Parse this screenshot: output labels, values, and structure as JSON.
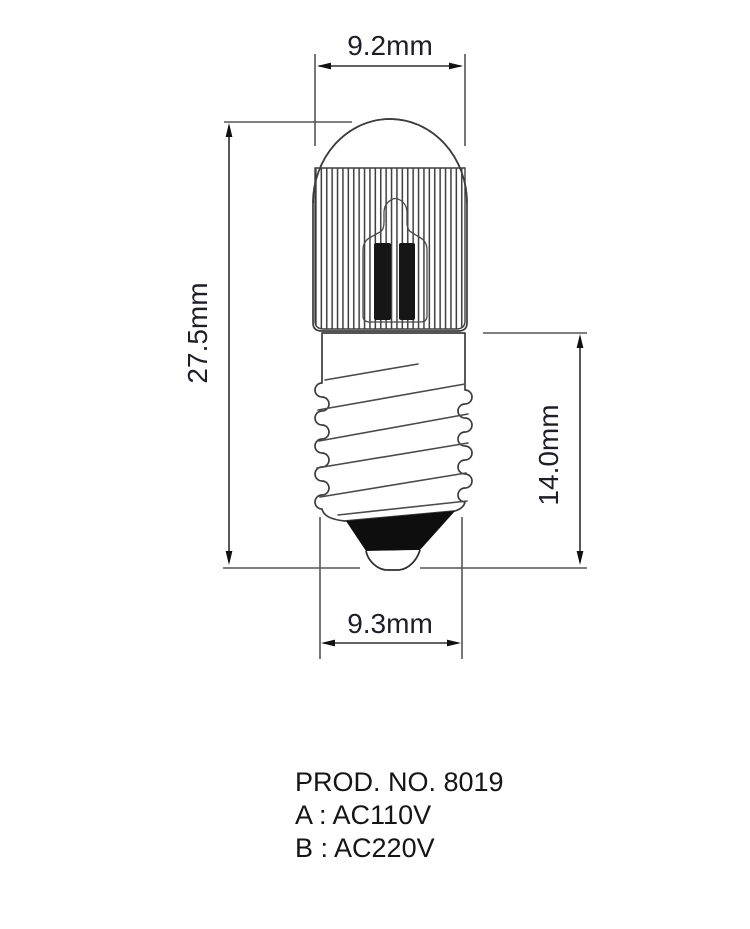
{
  "dimensions": {
    "bulb_diameter": "9.2mm",
    "overall_height": "27.5mm",
    "base_height": "14.0mm",
    "base_diameter": "9.3mm"
  },
  "product_info": {
    "product_number": "PROD. NO. 8019",
    "variant_a": "A : AC110V",
    "variant_b": "B : AC220V"
  },
  "colors": {
    "line": "#3c3c3c",
    "dimension_text": "#1d1d2b",
    "body_text": "#151515",
    "fill_dark": "#0e0e0e",
    "background": "#ffffff"
  }
}
